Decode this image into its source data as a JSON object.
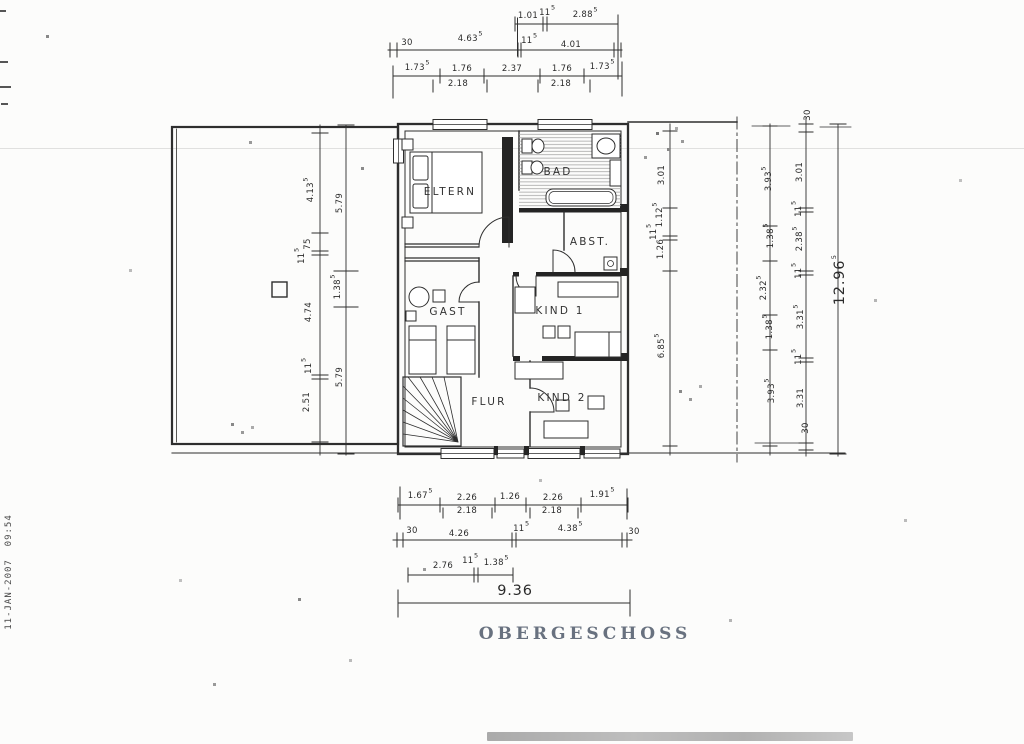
{
  "page": {
    "title": "OBERGESCHOSS",
    "date_stamp": "11-JAN-2007  09:54"
  },
  "colors": {
    "ink": "#2e2e2e",
    "title": "#68717f",
    "paper": "#fcfcfb"
  },
  "rooms": [
    {
      "label": "ELTERN",
      "x": 450,
      "y": 192
    },
    {
      "label": "BAD",
      "x": 558,
      "y": 172
    },
    {
      "label": "ABST.",
      "x": 590,
      "y": 242
    },
    {
      "label": "GAST",
      "x": 448,
      "y": 312
    },
    {
      "label": "KIND 1",
      "x": 560,
      "y": 311
    },
    {
      "label": "FLUR",
      "x": 489,
      "y": 402
    },
    {
      "label": "KIND 2",
      "x": 562,
      "y": 398
    }
  ],
  "dim_labels_h": [
    {
      "t": "1.01",
      "x": 528,
      "y": 16
    },
    {
      "t": "11",
      "sup": "5",
      "x": 547,
      "y": 12
    },
    {
      "t": "2.88",
      "sup": "5",
      "x": 585,
      "y": 14
    },
    {
      "t": "30",
      "x": 407,
      "y": 43
    },
    {
      "t": "4.63",
      "sup": "5",
      "x": 470,
      "y": 38
    },
    {
      "t": "11",
      "sup": "5",
      "x": 529,
      "y": 40
    },
    {
      "t": "4.01",
      "x": 571,
      "y": 45
    },
    {
      "t": "1.73",
      "sup": "5",
      "x": 417,
      "y": 67
    },
    {
      "t": "1.76",
      "x": 462,
      "y": 69
    },
    {
      "t": "2.37",
      "x": 512,
      "y": 69
    },
    {
      "t": "1.76",
      "x": 562,
      "y": 69
    },
    {
      "t": "1.73",
      "sup": "5",
      "x": 602,
      "y": 66
    },
    {
      "t": "2.18",
      "x": 458,
      "y": 84
    },
    {
      "t": "2.18",
      "x": 561,
      "y": 84
    },
    {
      "t": "1.67",
      "sup": "5",
      "x": 420,
      "y": 495
    },
    {
      "t": "2.26",
      "x": 467,
      "y": 498
    },
    {
      "t": "1.26",
      "x": 510,
      "y": 497
    },
    {
      "t": "2.26",
      "x": 553,
      "y": 498
    },
    {
      "t": "1.91",
      "sup": "5",
      "x": 602,
      "y": 494
    },
    {
      "t": "2.18",
      "x": 467,
      "y": 511
    },
    {
      "t": "2.18",
      "x": 552,
      "y": 511
    },
    {
      "t": "30",
      "x": 412,
      "y": 531
    },
    {
      "t": "4.26",
      "x": 459,
      "y": 534
    },
    {
      "t": "11",
      "sup": "5",
      "x": 521,
      "y": 528
    },
    {
      "t": "4.38",
      "sup": "5",
      "x": 570,
      "y": 528
    },
    {
      "t": "30",
      "x": 634,
      "y": 532
    },
    {
      "t": "2.76",
      "x": 443,
      "y": 566
    },
    {
      "t": "11",
      "sup": "5",
      "x": 470,
      "y": 560
    },
    {
      "t": "1.38",
      "sup": "5",
      "x": 496,
      "y": 562
    },
    {
      "t": "9.36",
      "x": 515,
      "y": 591,
      "big": true
    }
  ],
  "dim_labels_v": [
    {
      "t": "4.13",
      "sup": "5",
      "x": 310,
      "y": 190
    },
    {
      "t": "75",
      "x": 308,
      "y": 244
    },
    {
      "t": "11",
      "sup": "5",
      "x": 301,
      "y": 256
    },
    {
      "t": "4.74",
      "x": 309,
      "y": 312
    },
    {
      "t": "11",
      "sup": "5",
      "x": 308,
      "y": 366
    },
    {
      "t": "2.51",
      "x": 307,
      "y": 402
    },
    {
      "t": "5.79",
      "x": 340,
      "y": 203
    },
    {
      "t": "1.38",
      "sup": "5",
      "x": 337,
      "y": 287
    },
    {
      "t": "5.79",
      "x": 340,
      "y": 377
    },
    {
      "t": "3.01",
      "x": 662,
      "y": 175
    },
    {
      "t": "1.12",
      "sup": "5",
      "x": 659,
      "y": 215
    },
    {
      "t": "11",
      "sup": "5",
      "x": 653,
      "y": 232
    },
    {
      "t": "1.26",
      "x": 661,
      "y": 249
    },
    {
      "t": "6.85",
      "sup": "5",
      "x": 661,
      "y": 346
    },
    {
      "t": "3.93",
      "sup": "5",
      "x": 768,
      "y": 179
    },
    {
      "t": "1.38",
      "sup": "5",
      "x": 770,
      "y": 236
    },
    {
      "t": "2.32",
      "sup": "5",
      "x": 763,
      "y": 288
    },
    {
      "t": "1.38",
      "sup": "5",
      "x": 769,
      "y": 327
    },
    {
      "t": "3.93",
      "sup": "5",
      "x": 771,
      "y": 391
    },
    {
      "t": "30",
      "x": 808,
      "y": 115
    },
    {
      "t": "3.01",
      "x": 800,
      "y": 172
    },
    {
      "t": "11",
      "sup": "5",
      "x": 798,
      "y": 209
    },
    {
      "t": "2.38",
      "sup": "5",
      "x": 799,
      "y": 239
    },
    {
      "t": "11",
      "sup": "5",
      "x": 798,
      "y": 271
    },
    {
      "t": "3.31",
      "sup": "5",
      "x": 800,
      "y": 317
    },
    {
      "t": "11",
      "sup": "5",
      "x": 798,
      "y": 357
    },
    {
      "t": "3.31",
      "x": 801,
      "y": 398
    },
    {
      "t": "30",
      "x": 806,
      "y": 428
    },
    {
      "t": "12.96",
      "sup": "5",
      "x": 840,
      "y": 280,
      "big": true
    }
  ]
}
